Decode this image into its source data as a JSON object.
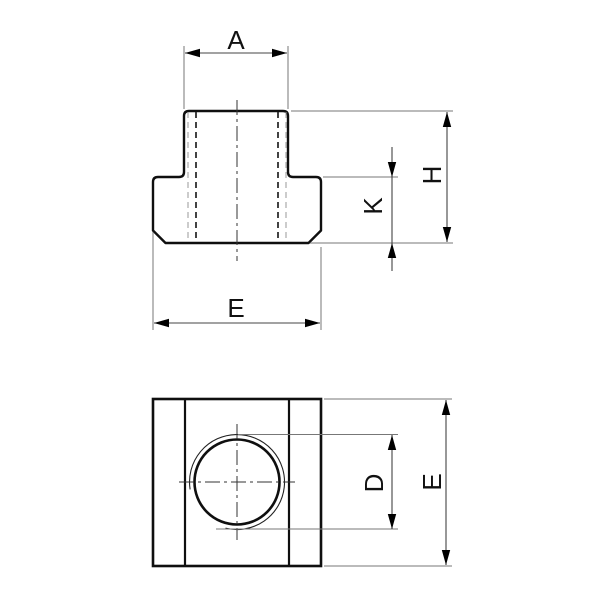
{
  "page": {
    "background_color": "#ffffff",
    "line_color": "#0f0f0f",
    "thin_line_color": "#777777"
  },
  "drawing": {
    "front_view": {
      "dims": {
        "top_width_label": "A",
        "total_height_label": "H",
        "base_height_label": "K",
        "base_width_label": "E"
      }
    },
    "top_view": {
      "dims": {
        "hole_diameter_label": "D",
        "overall_width_label": "E"
      }
    }
  }
}
